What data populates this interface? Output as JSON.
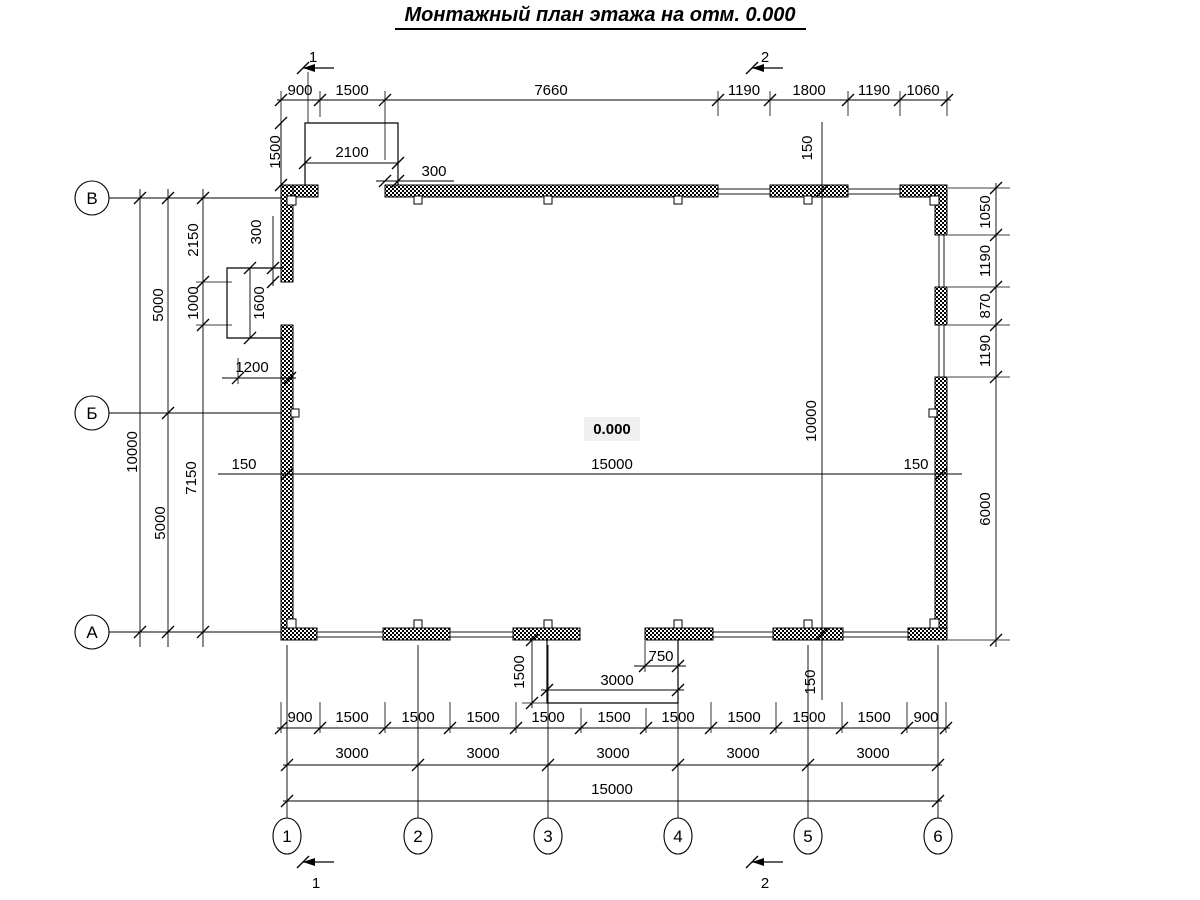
{
  "title": "Монтажный план этажа на отм. 0.000",
  "level_mark": "0.000",
  "axes": {
    "rows": [
      "В",
      "Б",
      "А"
    ],
    "cols": [
      "1",
      "2",
      "3",
      "4",
      "5",
      "6"
    ]
  },
  "sections": {
    "s1": "1",
    "s2": "2"
  },
  "dims": {
    "top_chain": [
      "900",
      "1500",
      "7660",
      "1190",
      "1800",
      "1190",
      "1060"
    ],
    "top_porch_width": "2100",
    "top_porch_height": "1500",
    "top_porch_offset": "300",
    "left_total": "10000",
    "left_5000_upper": "5000",
    "left_5000_lower": "5000",
    "left_2150": "2150",
    "left_1000": "1000",
    "left_7150": "7150",
    "left_porch_height": "1600",
    "left_porch_offset": "300",
    "left_porch_width": "1200",
    "right_chain": [
      "1050",
      "1190",
      "870",
      "1190",
      "6000"
    ],
    "int_width_left": "150",
    "int_width": "15000",
    "int_width_right": "150",
    "int_height_top": "150",
    "int_height": "10000",
    "int_height_bottom": "150",
    "bottom_porch_height": "1500",
    "bottom_porch_offset": "750",
    "bottom_porch_width": "3000",
    "bottom_fine": [
      "900",
      "1500",
      "1500",
      "1500",
      "1500",
      "1500",
      "1500",
      "1500",
      "1500",
      "1500",
      "900"
    ],
    "bottom_main": [
      "3000",
      "3000",
      "3000",
      "3000",
      "3000"
    ],
    "bottom_total": "15000"
  }
}
